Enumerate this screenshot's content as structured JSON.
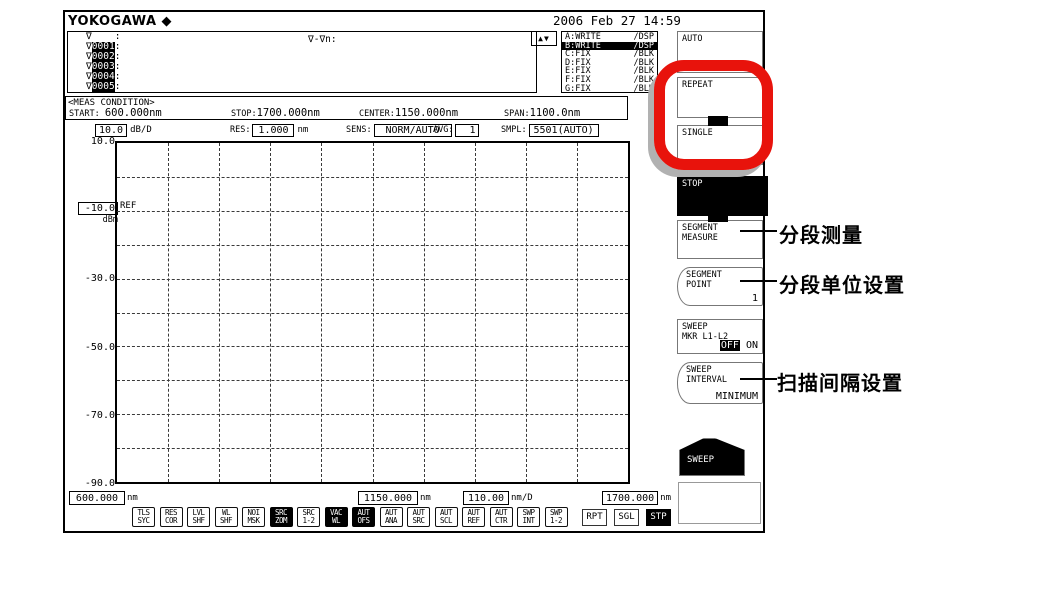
{
  "header": {
    "brand": "YOKOGAWA",
    "brand_mark": "◆",
    "datetime": "2006 Feb 27 14:59"
  },
  "trace_list": {
    "updown": "▲▼",
    "formula_label": "∇-∇n:",
    "rows": [
      {
        "mark": "∇",
        "num": "",
        "sep": ":"
      },
      {
        "mark": "∇",
        "num": "0001",
        "sep": ":"
      },
      {
        "mark": "∇",
        "num": "0002",
        "sep": ":"
      },
      {
        "mark": "∇",
        "num": "0003",
        "sep": ":"
      },
      {
        "mark": "∇",
        "num": "0004",
        "sep": ":"
      },
      {
        "mark": "∇",
        "num": "0005",
        "sep": ":"
      }
    ]
  },
  "trace_status": {
    "rows": [
      {
        "name": "A:WRITE",
        "disp": "/DSP",
        "active": false
      },
      {
        "name": "B:WRITE",
        "disp": "/DSP",
        "active": true
      },
      {
        "name": "C:FIX",
        "disp": "/BLK",
        "active": false
      },
      {
        "name": "D:FIX",
        "disp": "/BLK",
        "active": false
      },
      {
        "name": "E:FIX",
        "disp": "/BLK",
        "active": false
      },
      {
        "name": "F:FIX",
        "disp": "/BLK",
        "active": false
      },
      {
        "name": "G:FIX",
        "disp": "/BLK",
        "active": false
      }
    ]
  },
  "meas_condition": {
    "title": "<MEAS CONDITION>",
    "start_label": "START:",
    "start_value": "600.000nm",
    "stop_label": "STOP:",
    "stop_value": "1700.000nm",
    "center_label": "CENTER:",
    "center_value": "1150.000nm",
    "span_label": "SPAN:",
    "span_value": "1100.0nm"
  },
  "params": {
    "level_scale": "10.0",
    "level_scale_unit": "dB/D",
    "res_label": "RES:",
    "res_value": "1.000",
    "res_unit": "nm",
    "sens_label": "SENS:",
    "sens_value": "NORM/AUTO",
    "avg_label": "AVG:",
    "avg_value": "1",
    "smpl_label": "SMPL:",
    "smpl_value": "5501(AUTO)"
  },
  "graph": {
    "ref_marker": "REF",
    "y_axis": {
      "top": "10.0",
      "ref": "-10.0",
      "ref_unit": "dBm",
      "l30": "-30.0",
      "l50": "-50.0",
      "l70": "-70.0",
      "l90": "-90.0"
    },
    "x_axis": {
      "start": "600.000",
      "start_unit": "nm",
      "center": "1150.000",
      "center_unit": "nm",
      "scale": "110.00",
      "scale_unit": "nm/D",
      "stop": "1700.000",
      "stop_unit": "nm"
    }
  },
  "status_bar": {
    "indicators": [
      {
        "l1": "TLS",
        "l2": "SYC",
        "active": false
      },
      {
        "l1": "RES",
        "l2": "COR",
        "active": false
      },
      {
        "l1": "LVL",
        "l2": "SHF",
        "active": false
      },
      {
        "l1": "WL",
        "l2": "SHF",
        "active": false
      },
      {
        "l1": "NOI",
        "l2": "MSK",
        "active": false
      },
      {
        "l1": "SRC",
        "l2": "ZOM",
        "active": true
      },
      {
        "l1": "SRC",
        "l2": "1-2",
        "active": false
      },
      {
        "l1": "VAC",
        "l2": "WL",
        "active": true
      },
      {
        "l1": "AUT",
        "l2": "OFS",
        "active": true
      },
      {
        "l1": "AUT",
        "l2": "ANA",
        "active": false
      },
      {
        "l1": "AUT",
        "l2": "SRC",
        "active": false
      },
      {
        "l1": "AUT",
        "l2": "SCL",
        "active": false
      },
      {
        "l1": "AUT",
        "l2": "REF",
        "active": false
      },
      {
        "l1": "AUT",
        "l2": "CTR",
        "active": false
      },
      {
        "l1": "SWP",
        "l2": "INT",
        "active": false
      },
      {
        "l1": "SWP",
        "l2": "1-2",
        "active": false
      }
    ],
    "sweep_modes": [
      {
        "label": "RPT",
        "active": false
      },
      {
        "label": "SGL",
        "active": false
      },
      {
        "label": "STP",
        "active": true
      }
    ]
  },
  "softkeys": {
    "auto": "AUTO",
    "repeat": "REPEAT",
    "single": "SINGLE",
    "stop": "STOP",
    "segment_measure": {
      "line1": "SEGMENT",
      "line2": "MEASURE"
    },
    "segment_point": {
      "line1": "SEGMENT",
      "line2": "POINT",
      "value": "1"
    },
    "sweep_marker": {
      "line1": "SWEEP",
      "line2": "MKR L1-L2",
      "off": "OFF",
      "on": "ON"
    },
    "sweep_interval": {
      "line1": "SWEEP",
      "line2": "INTERVAL",
      "value": "MINIMUM"
    },
    "sweep_menu": "SWEEP"
  },
  "annotations": [
    {
      "text": "分段测量"
    },
    {
      "text": "分段单位设置"
    },
    {
      "text": "扫描间隔设置"
    }
  ],
  "highlight_color": "#e8130c"
}
